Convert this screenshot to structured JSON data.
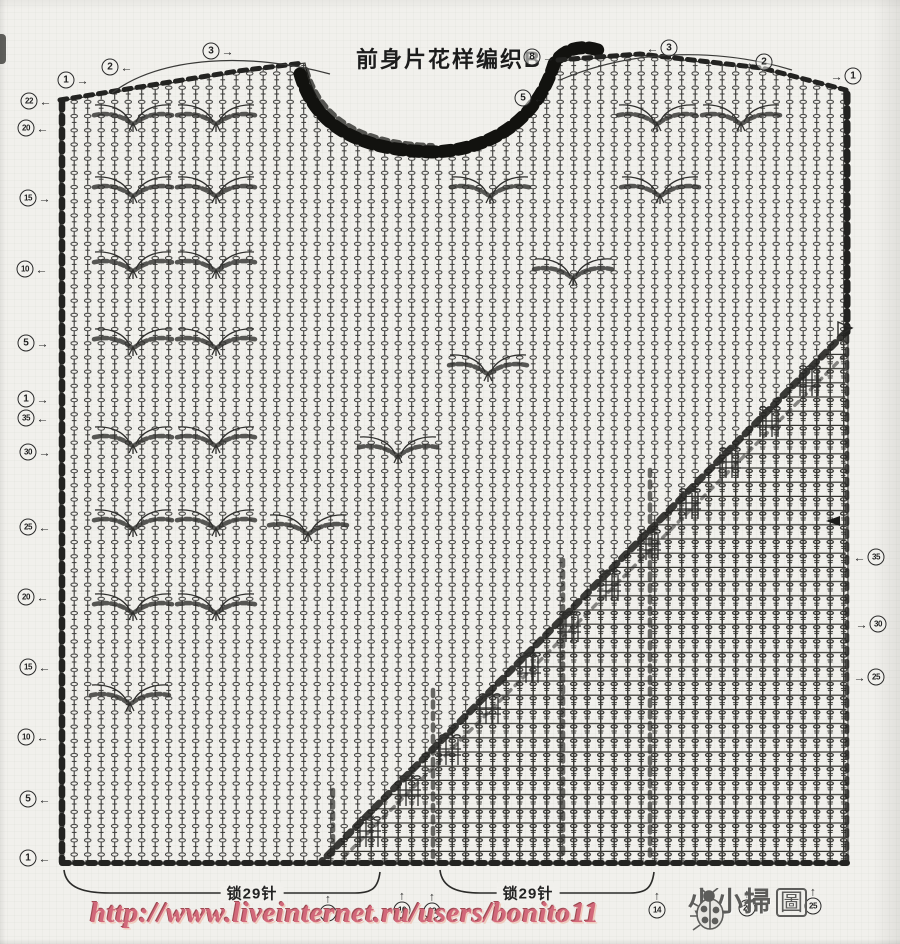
{
  "title": {
    "text": "前身片花样编织B"
  },
  "cast_on": {
    "left_label": "锁29针",
    "right_label": "锁29针",
    "left_center": {
      "x": 252,
      "y": 893
    },
    "right_center": {
      "x": 528,
      "y": 893
    }
  },
  "markers": {
    "circles": [
      {
        "n": "1",
        "x": 73,
        "y": 80,
        "arrow": "→",
        "side": "right"
      },
      {
        "n": "2",
        "x": 117,
        "y": 67,
        "arrow": "←",
        "side": "right"
      },
      {
        "n": "3",
        "x": 218,
        "y": 51,
        "arrow": "→",
        "side": "right"
      },
      {
        "n": "8",
        "x": 539,
        "y": 57,
        "arrow": "→",
        "side": "right"
      },
      {
        "n": "5",
        "x": 530,
        "y": 98,
        "arrow": "←",
        "side": "right"
      },
      {
        "n": "3",
        "x": 662,
        "y": 48,
        "arrow": "←",
        "side": "left"
      },
      {
        "n": "2",
        "x": 757,
        "y": 62,
        "arrow": "→",
        "side": "left"
      },
      {
        "n": "1",
        "x": 846,
        "y": 76,
        "arrow": "→",
        "side": "left"
      },
      {
        "n": "22",
        "x": 36,
        "y": 101,
        "arrow": "←",
        "side": "right"
      },
      {
        "n": "20",
        "x": 33,
        "y": 128,
        "arrow": "←",
        "side": "right"
      },
      {
        "n": "15",
        "x": 35,
        "y": 198,
        "arrow": "→",
        "side": "right"
      },
      {
        "n": "10",
        "x": 32,
        "y": 269,
        "arrow": "←",
        "side": "right"
      },
      {
        "n": "5",
        "x": 33,
        "y": 343,
        "arrow": "→",
        "side": "right"
      },
      {
        "n": "1",
        "x": 33,
        "y": 399,
        "arrow": "→",
        "side": "right"
      },
      {
        "n": "35",
        "x": 33,
        "y": 418,
        "arrow": "←",
        "side": "right"
      },
      {
        "n": "30",
        "x": 35,
        "y": 452,
        "arrow": "→",
        "side": "right"
      },
      {
        "n": "25",
        "x": 35,
        "y": 527,
        "arrow": "←",
        "side": "right"
      },
      {
        "n": "20",
        "x": 33,
        "y": 597,
        "arrow": "←",
        "side": "right"
      },
      {
        "n": "15",
        "x": 35,
        "y": 667,
        "arrow": "←",
        "side": "right"
      },
      {
        "n": "10",
        "x": 33,
        "y": 737,
        "arrow": "←",
        "side": "right"
      },
      {
        "n": "5",
        "x": 35,
        "y": 799,
        "arrow": "←",
        "side": "right"
      },
      {
        "n": "1",
        "x": 35,
        "y": 858,
        "arrow": "←",
        "side": "right"
      },
      {
        "n": "35",
        "x": 869,
        "y": 557,
        "arrow": "←",
        "side": "left"
      },
      {
        "n": "30",
        "x": 871,
        "y": 624,
        "arrow": "→",
        "side": "left"
      },
      {
        "n": "25",
        "x": 869,
        "y": 677,
        "arrow": "→",
        "side": "left"
      },
      {
        "n": "5",
        "x": 328,
        "y": 907,
        "arrow": "↑",
        "side": "top"
      },
      {
        "n": "10",
        "x": 402,
        "y": 904,
        "arrow": "↑",
        "side": "top"
      },
      {
        "n": "12",
        "x": 432,
        "y": 905,
        "arrow": "↑",
        "side": "top"
      },
      {
        "n": "14",
        "x": 657,
        "y": 904,
        "arrow": "↑",
        "side": "top"
      },
      {
        "n": "20",
        "x": 747,
        "y": 902,
        "arrow": "↑",
        "side": "top"
      },
      {
        "n": "25",
        "x": 813,
        "y": 900,
        "arrow": "↑",
        "side": "top"
      }
    ]
  },
  "footer": {
    "url": "http://www.liveinternet.ru/users/bonito11",
    "watermark_text": "小小掃",
    "watermark_seal": "圖"
  },
  "colors": {
    "ink": "#2e2e2c",
    "paper": "#f1f0ec",
    "url_pink": "#d2687a",
    "watermark_gray": "#5d5d5b"
  }
}
